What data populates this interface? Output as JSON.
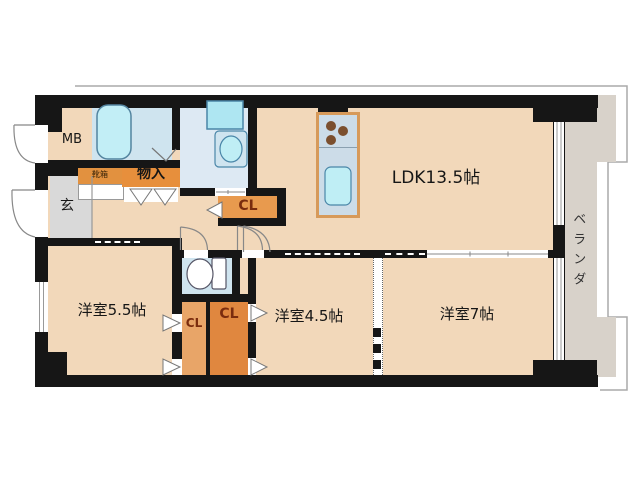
{
  "plan": {
    "type": "floorplan",
    "labels": {
      "mb": "MB",
      "entrance": "玄",
      "storage": "物入",
      "shoe_cabinet": "靴箱",
      "closet_hall": "CL",
      "closet_left": "CL",
      "closet_right": "CL",
      "ldk": "LDK13.5帖",
      "western_5_5": "洋室5.5帖",
      "western_4_5": "洋室4.5帖",
      "western_7": "洋室7帖",
      "veranda": "ベランダ"
    },
    "colors": {
      "wall": "#161616",
      "floor_tan": "#f2d8ba",
      "genkan_gray": "#d9d9d9",
      "wet_room_blue": "#cfe4ef",
      "washroom_blue": "#dde9f3",
      "fixture_cyan": "#bfeef5",
      "fixture_stroke": "#4a86a8",
      "closet_orange_dark": "#e0873f",
      "closet_orange_light": "#e8a568",
      "label_orange": "#e78f3c",
      "closet_text": "#7a2c0e",
      "veranda_gray": "#d8d2ca",
      "kitchen_counter": "#ccdce8",
      "kitchen_border": "#d79a5a",
      "burner_brown": "#7b4f2e"
    }
  }
}
